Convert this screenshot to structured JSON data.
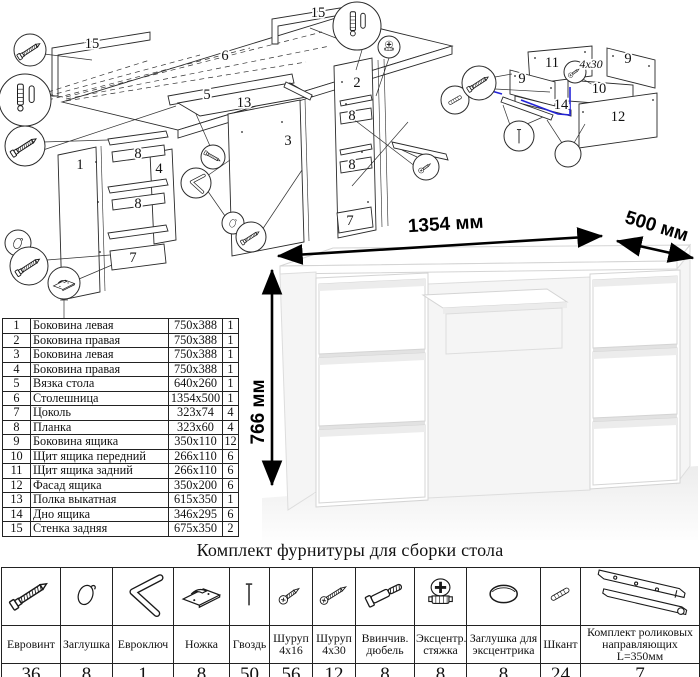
{
  "colors": {
    "accent_blue": "#2323d8",
    "ink": "#1a1a1a"
  },
  "exploded_diagram": {
    "labels": [
      {
        "t": "15",
        "x": 92,
        "y": 48
      },
      {
        "t": "6",
        "x": 225,
        "y": 60
      },
      {
        "t": "15",
        "x": 318,
        "y": 17
      },
      {
        "t": "5",
        "x": 207,
        "y": 99
      },
      {
        "t": "13",
        "x": 244,
        "y": 107
      },
      {
        "t": "3",
        "x": 288,
        "y": 145
      },
      {
        "t": "2",
        "x": 357,
        "y": 87
      },
      {
        "t": "1",
        "x": 80,
        "y": 169
      },
      {
        "t": "8",
        "x": 138,
        "y": 158
      },
      {
        "t": "4",
        "x": 159,
        "y": 173
      },
      {
        "t": "8",
        "x": 138,
        "y": 208
      },
      {
        "t": "7",
        "x": 133,
        "y": 262
      },
      {
        "t": "8",
        "x": 352,
        "y": 120
      },
      {
        "t": "8",
        "x": 352,
        "y": 169
      },
      {
        "t": "7",
        "x": 350,
        "y": 225
      }
    ]
  },
  "drawer_diagram": {
    "labels": [
      {
        "t": "11",
        "x": 97,
        "y": 37
      },
      {
        "t": "9",
        "x": 173,
        "y": 33
      },
      {
        "t": "9",
        "x": 67,
        "y": 53
      },
      {
        "t": "10",
        "x": 144,
        "y": 63
      },
      {
        "t": "14",
        "x": 106,
        "y": 79
      },
      {
        "t": "12",
        "x": 163,
        "y": 91
      },
      {
        "t": "4x30",
        "x": 136,
        "y": 38,
        "cls": "note"
      }
    ]
  },
  "desk": {
    "width_label": "1354 мм",
    "depth_label": "500 мм",
    "height_label": "766 мм"
  },
  "parts_table": {
    "rows": [
      {
        "num": "1",
        "name": "Боковина левая",
        "size": "750x388",
        "qty": "1"
      },
      {
        "num": "2",
        "name": "Боковина правая",
        "size": "750x388",
        "qty": "1"
      },
      {
        "num": "3",
        "name": "Боковина левая",
        "size": "750x388",
        "qty": "1"
      },
      {
        "num": "4",
        "name": "Боковина правая",
        "size": "750x388",
        "qty": "1"
      },
      {
        "num": "5",
        "name": "Вязка стола",
        "size": "640x260",
        "qty": "1"
      },
      {
        "num": "6",
        "name": "Столешница",
        "size": "1354x500",
        "qty": "1"
      },
      {
        "num": "7",
        "name": "Цоколь",
        "size": "323x74",
        "qty": "4"
      },
      {
        "num": "8",
        "name": "Планка",
        "size": "323x60",
        "qty": "4"
      },
      {
        "num": "9",
        "name": "Боковина ящика",
        "size": "350x110",
        "qty": "12"
      },
      {
        "num": "10",
        "name": "Щит ящика передний",
        "size": "266x110",
        "qty": "6"
      },
      {
        "num": "11",
        "name": "Щит ящика задний",
        "size": "266x110",
        "qty": "6"
      },
      {
        "num": "12",
        "name": "Фасад ящика",
        "size": "350x200",
        "qty": "6"
      },
      {
        "num": "13",
        "name": "Полка выкатная",
        "size": "615x350",
        "qty": "1"
      },
      {
        "num": "14",
        "name": "Дно ящика",
        "size": "346x295",
        "qty": "6"
      },
      {
        "num": "15",
        "name": "Стенка задняя",
        "size": "675x350",
        "qty": "2"
      }
    ]
  },
  "hardware_kit": {
    "title": "Комплект фурнитуры для сборки стола",
    "items": [
      {
        "icon": "confirmat",
        "name": "Евровинт",
        "qty": "36"
      },
      {
        "icon": "plug",
        "name": "Заглушка",
        "qty": "8"
      },
      {
        "icon": "hexkey",
        "name": "Евроключ",
        "qty": "1"
      },
      {
        "icon": "foot",
        "name": "Ножка",
        "qty": "8"
      },
      {
        "icon": "nail",
        "name": "Гвоздь",
        "qty": "50"
      },
      {
        "icon": "screw-short",
        "name": "Шуруп 4x16",
        "qty": "56"
      },
      {
        "icon": "screw-long",
        "name": "Шуруп 4x30",
        "qty": "12"
      },
      {
        "icon": "threaded-dowel",
        "name": "Ввинчив. дюбель",
        "qty": "8"
      },
      {
        "icon": "cam",
        "name": "Эксцентр. стяжка",
        "qty": "8"
      },
      {
        "icon": "cam-cover",
        "name": "Заглушка для эксцентрика",
        "qty": "8"
      },
      {
        "icon": "dowel",
        "name": "Шкант",
        "qty": "24"
      },
      {
        "icon": "slides",
        "name": "Комплект роликовых направляющих L=350мм",
        "qty": "7"
      }
    ]
  }
}
